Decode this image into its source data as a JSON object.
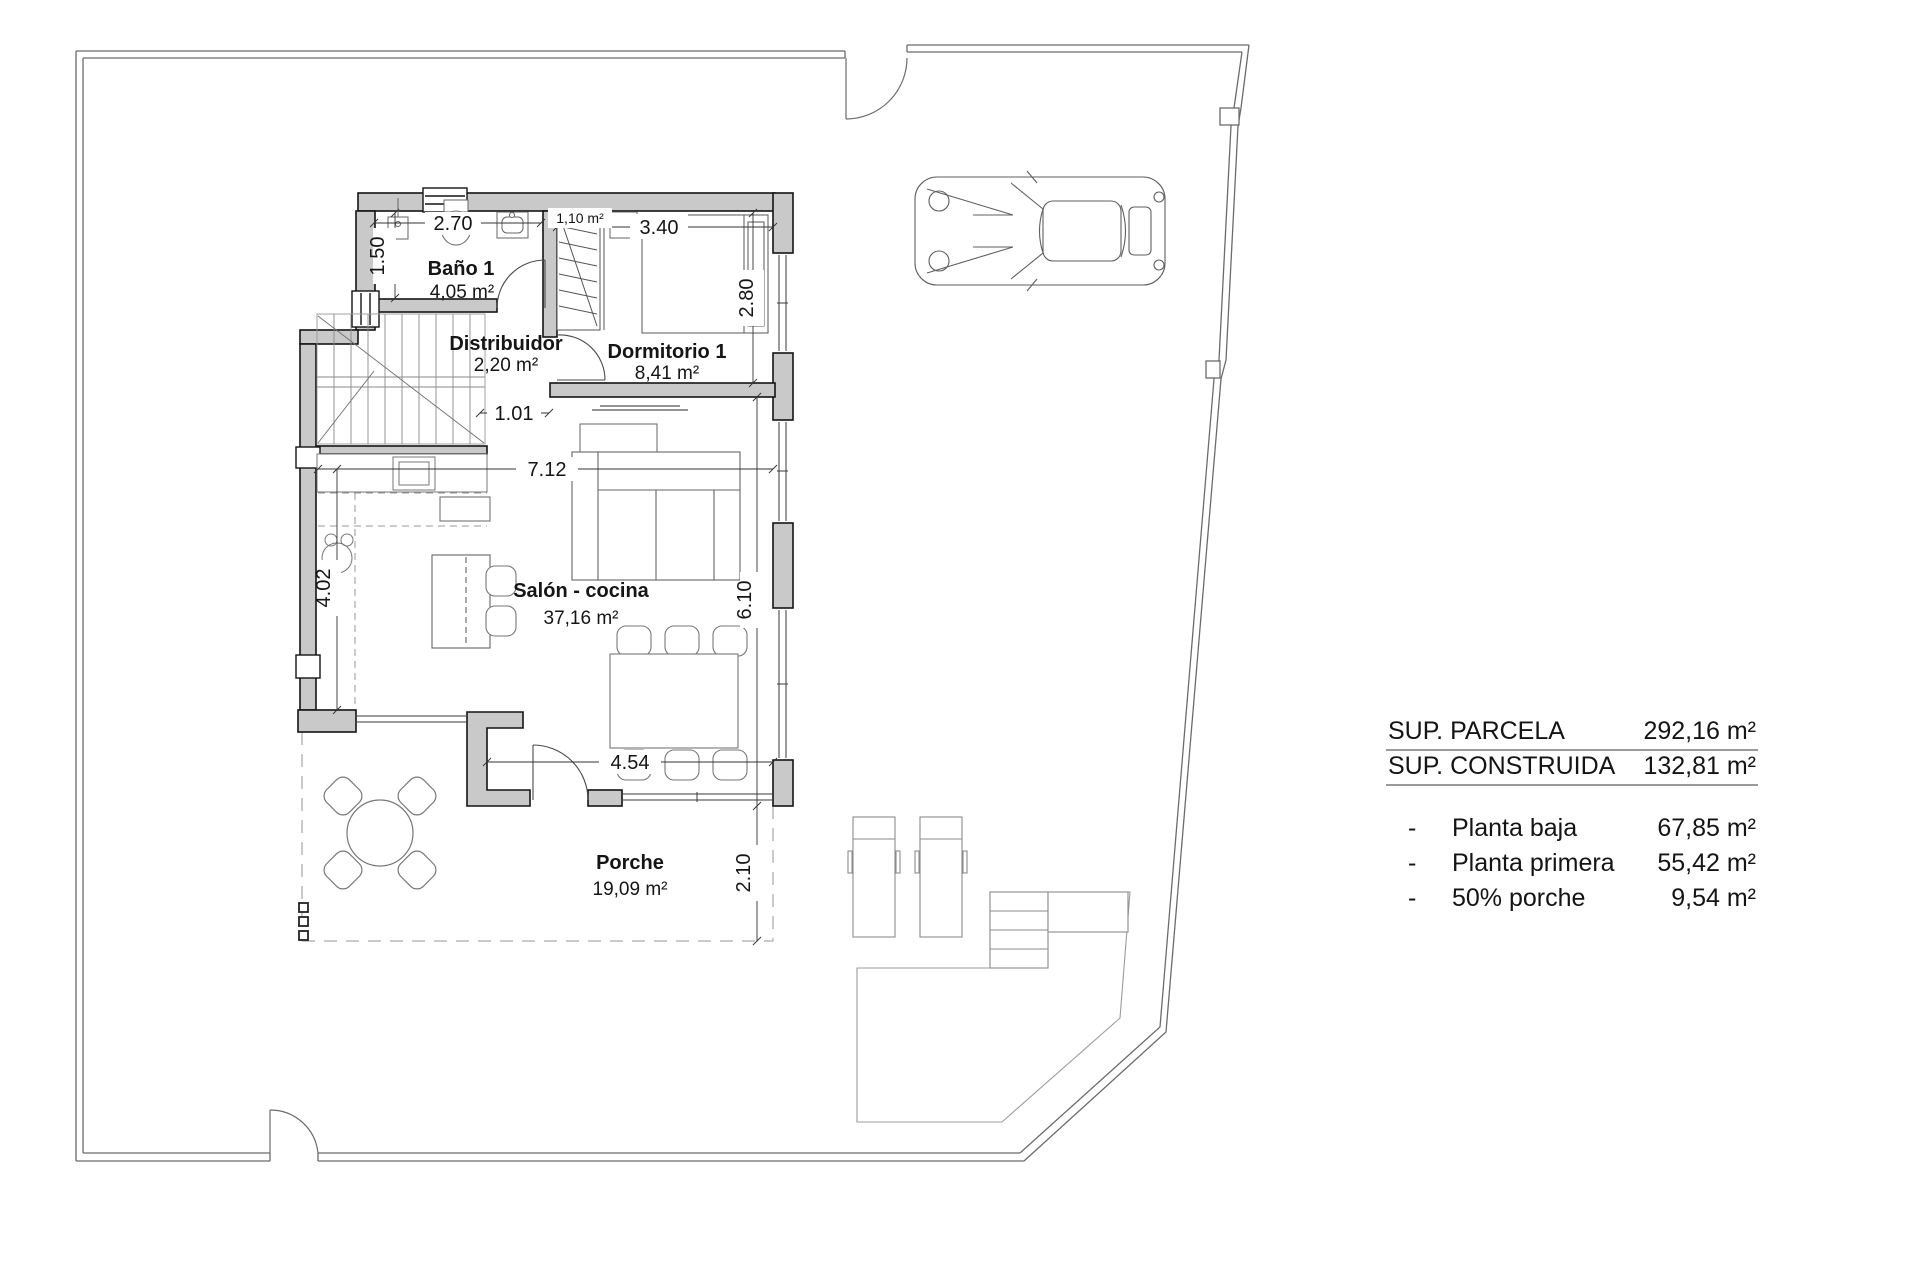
{
  "rooms": {
    "bano": {
      "name": "Baño 1",
      "area": "4,05 m²"
    },
    "distribuidor": {
      "name": "Distribuidor",
      "area": "2,20 m²"
    },
    "dormitorio": {
      "name": "Dormitorio 1",
      "area": "8,41 m²"
    },
    "salon": {
      "name": "Salón - cocina",
      "area": "37,16 m²"
    },
    "porche": {
      "name": "Porche",
      "area": "19,09 m²"
    },
    "armario_area": "1,10 m²"
  },
  "dims": {
    "bano_width": "2.70",
    "bano_depth": "1.50",
    "dorm_width": "3.40",
    "dorm_depth": "2.80",
    "hall_opening": "1.01",
    "salon_width": "7.12",
    "salon_left_depth": "4.02",
    "salon_right_depth": "6.10",
    "porch_width": "4.54",
    "porch_depth": "2.10"
  },
  "summary": {
    "rows": [
      {
        "label": "SUP. PARCELA",
        "value": "292,16 m²"
      },
      {
        "label": "SUP. CONSTRUIDA",
        "value": "132,81 m²"
      }
    ],
    "items": [
      {
        "bullet": "-",
        "label": "Planta baja",
        "value": "67,85 m²"
      },
      {
        "bullet": "-",
        "label": "Planta primera",
        "value": "55,42 m²"
      },
      {
        "bullet": "-",
        "label": "50% porche",
        "value": "9,54 m²"
      }
    ]
  }
}
